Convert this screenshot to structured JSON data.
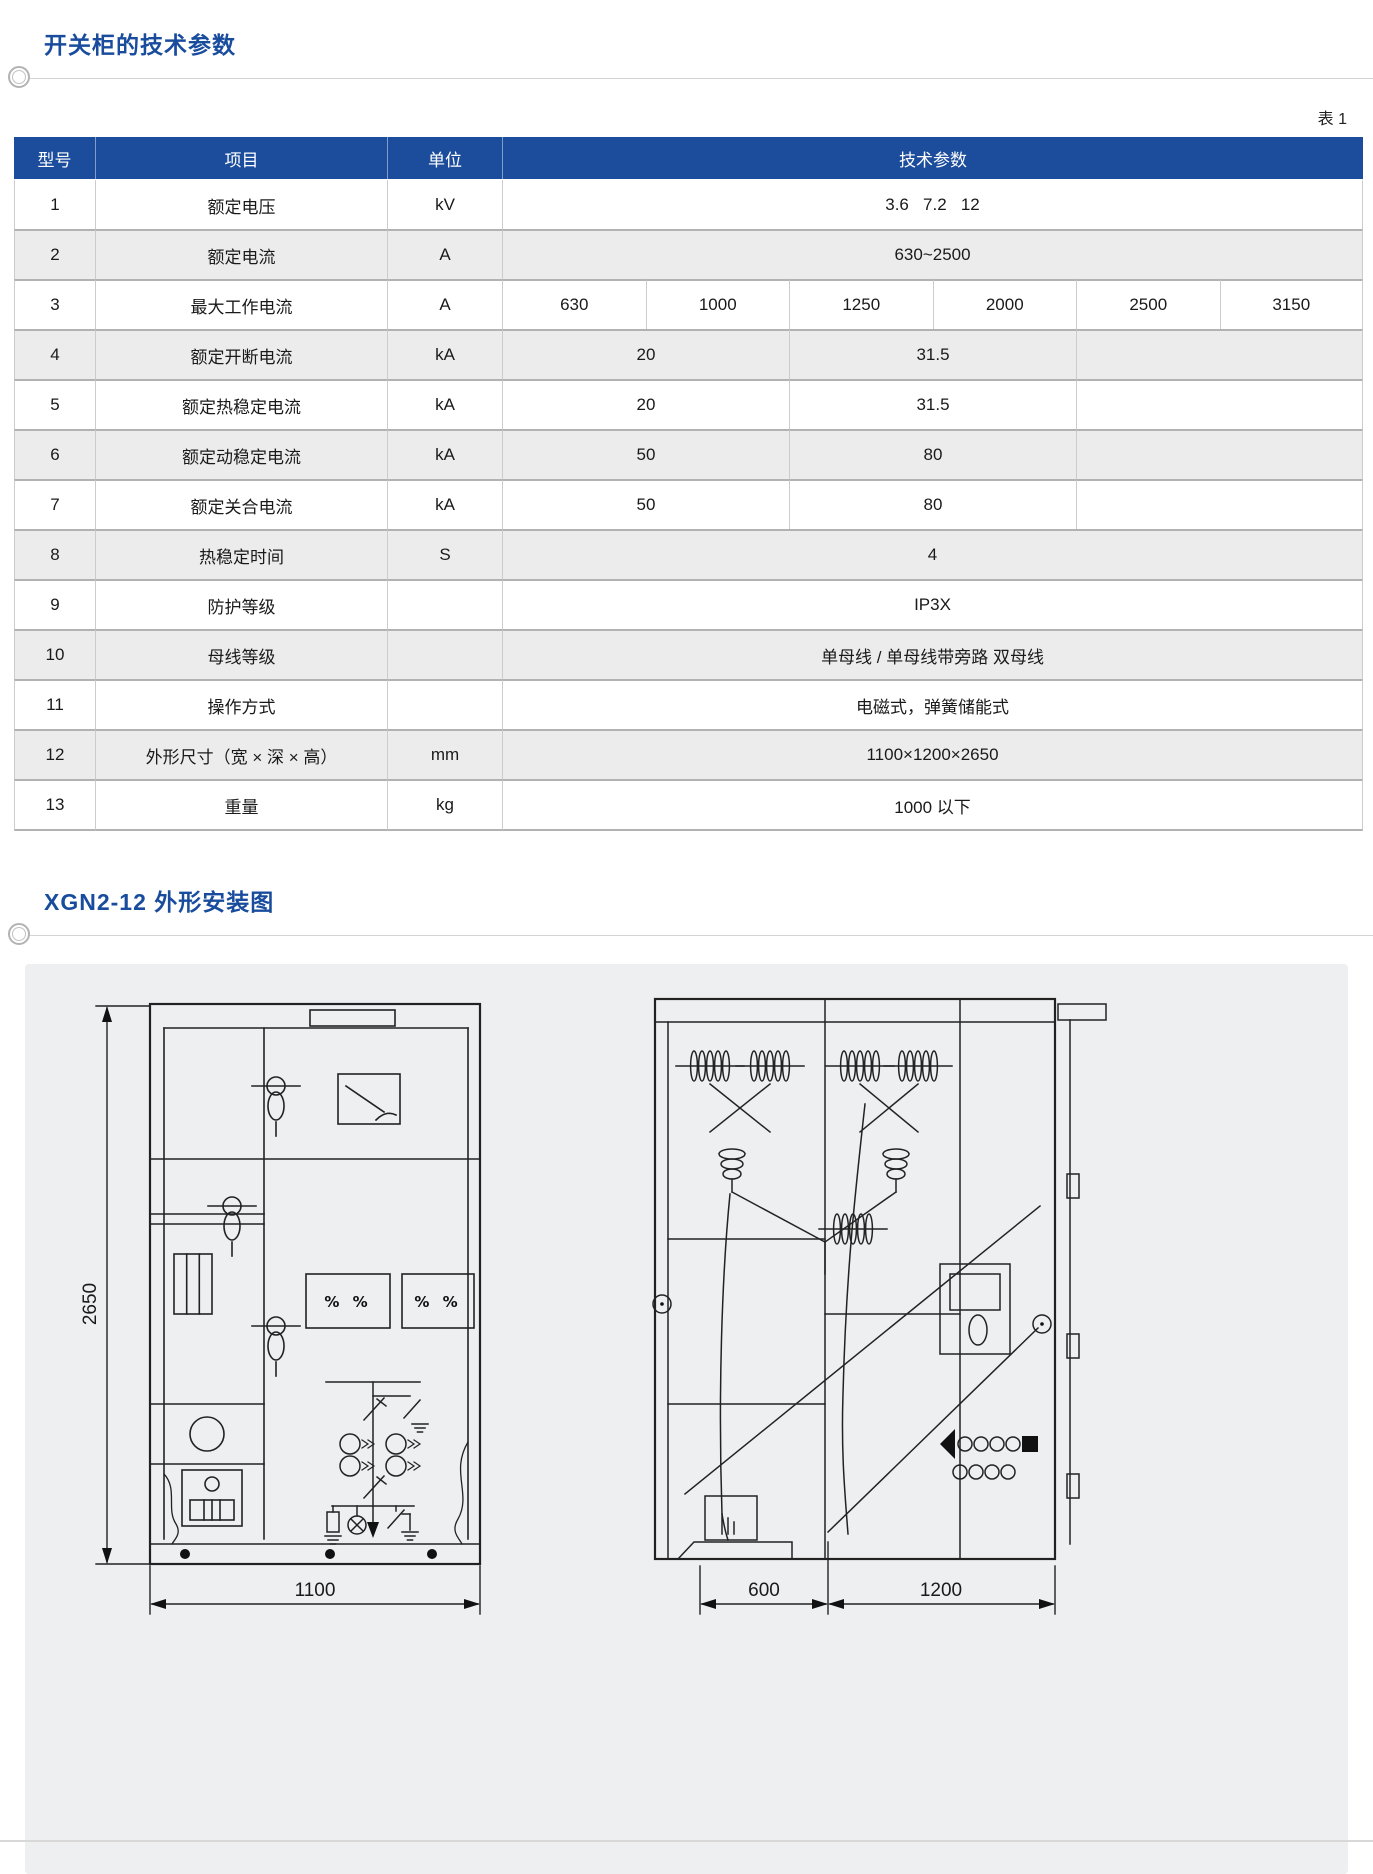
{
  "page": {
    "section1_title": "开关柜的技术参数",
    "table_label": "表 1",
    "section2_title": "XGN2-12 外形安装图"
  },
  "colors": {
    "accent_blue": "#1a4c9e",
    "table_header_bg": "#1c4d9c",
    "row_alt_bg": "#ececec",
    "panel_bg": "#edeff0"
  },
  "table": {
    "headers": [
      "型号",
      "项目",
      "单位",
      "技术参数"
    ],
    "rows": [
      {
        "no": "1",
        "item": "额定电压",
        "unit": "kV",
        "values": [
          "3.6   7.2   12"
        ]
      },
      {
        "no": "2",
        "item": "额定电流",
        "unit": "A",
        "values": [
          "630~2500"
        ]
      },
      {
        "no": "3",
        "item": "最大工作电流",
        "unit": "A",
        "values": [
          "630",
          "1000",
          "1250",
          "2000",
          "2500",
          "3150"
        ]
      },
      {
        "no": "4",
        "item": "额定开断电流",
        "unit": "kA",
        "values": [
          "20",
          "31.5",
          ""
        ]
      },
      {
        "no": "5",
        "item": "额定热稳定电流",
        "unit": "kA",
        "values": [
          "20",
          "31.5",
          ""
        ]
      },
      {
        "no": "6",
        "item": "额定动稳定电流",
        "unit": "kA",
        "values": [
          "50",
          "80",
          ""
        ]
      },
      {
        "no": "7",
        "item": "额定关合电流",
        "unit": "kA",
        "values": [
          "50",
          "80",
          ""
        ]
      },
      {
        "no": "8",
        "item": "热稳定时间",
        "unit": "S",
        "values": [
          "4"
        ]
      },
      {
        "no": "9",
        "item": "防护等级",
        "unit": "",
        "values": [
          "IP3X"
        ]
      },
      {
        "no": "10",
        "item": "母线等级",
        "unit": "",
        "values": [
          "单母线 / 单母线带旁路 双母线"
        ]
      },
      {
        "no": "11",
        "item": "操作方式",
        "unit": "",
        "values": [
          "电磁式，弹簧储能式"
        ]
      },
      {
        "no": "12",
        "item": "外形尺寸（宽 × 深 × 高）",
        "unit": "mm",
        "values": [
          "1100×1200×2650"
        ]
      },
      {
        "no": "13",
        "item": "重量",
        "unit": "kg",
        "values": [
          "1000 以下"
        ]
      }
    ]
  },
  "drawings": {
    "front_view": {
      "height_dim": "2650",
      "width_dim": "1100",
      "panel_symbols": "% %"
    },
    "side_view": {
      "depth_dim_1": "600",
      "depth_dim_2": "1200"
    }
  }
}
